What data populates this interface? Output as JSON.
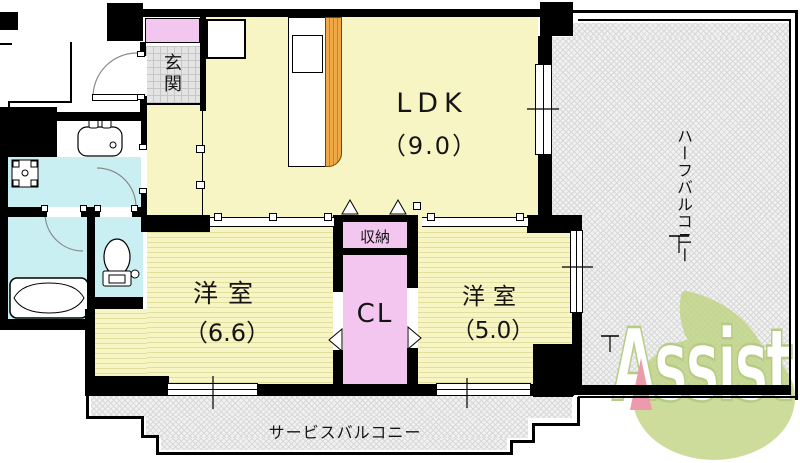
{
  "page": {
    "type": "apartment-floor-plan"
  },
  "rooms": {
    "ldk": {
      "label": "LDK",
      "size": "（9.0）"
    },
    "bedroom_left": {
      "label": "洋室",
      "size": "（6.6）"
    },
    "bedroom_right": {
      "label": "洋室",
      "size": "（5.0）"
    },
    "closet": {
      "label": "CL"
    },
    "storage": {
      "label": "収納"
    },
    "entrance": {
      "label": "玄関"
    }
  },
  "balconies": {
    "half": {
      "label": "ハーフバルコニー"
    },
    "service": {
      "label": "サービスバルコニー"
    }
  },
  "logo": {
    "text": "Assist"
  },
  "fixtures": [
    "entrance-door",
    "gas-stove",
    "kitchen-sink",
    "pipe-space",
    "washbasin",
    "washing-machine-pan",
    "bathtub",
    "toilet",
    "sliding-doors",
    "closet-folding-doors"
  ],
  "colors": {
    "wall_black": "#000000",
    "room_yellow": "#f7f5c3",
    "closet_pink": "#f3c6f0",
    "wet_area_blue": "#c9eff3",
    "balcony_gray": "#f1f1f1",
    "counter_orange": "#efa845",
    "logo_green": "#bfd37f",
    "logo_accent_pink": "#ed9bac"
  }
}
